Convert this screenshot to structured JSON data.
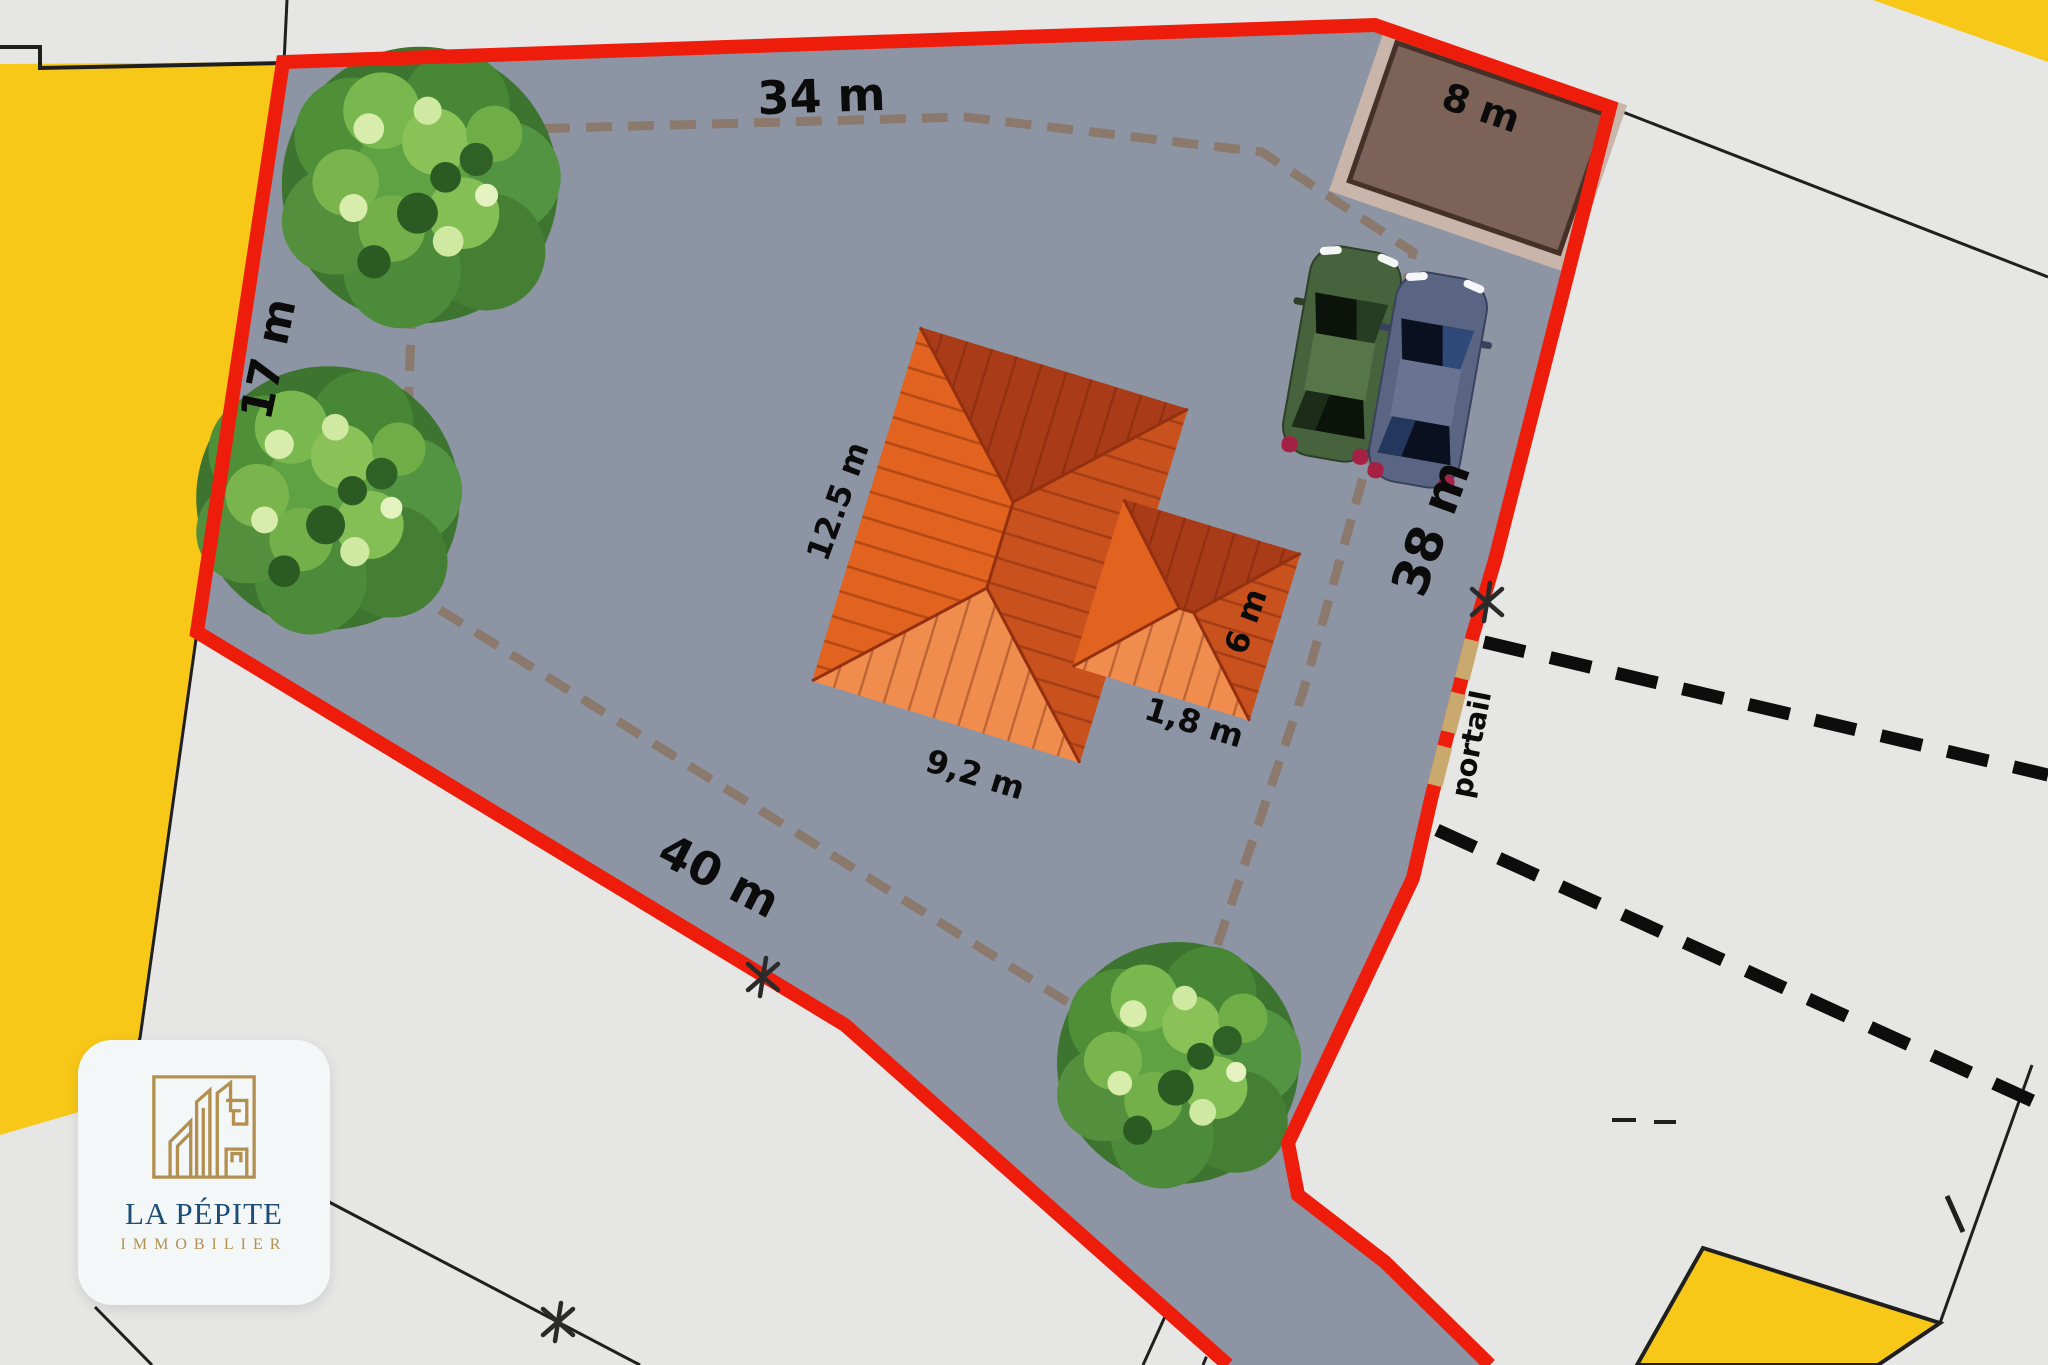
{
  "site_plan": {
    "colors": {
      "background": "#e6e6e5",
      "plot_fill": "#8d95a4",
      "boundary_red": "#ee1d0b",
      "parcel_yellow": "#f8c818",
      "inner_dash": "#8a796c",
      "road_dash": "#0d0d0d",
      "gate_tan": "#c9a96e",
      "roof_light": "#f08d4e",
      "roof_mid": "#e2631f",
      "roof_side": "#c8511e",
      "roof_dark": "#a93b18",
      "garage_fill": "#7c6257",
      "garage_frame": "#c9b5a9",
      "tree_green": "#4f8f38",
      "car_green": "#46633d",
      "car_blue": "#5a6483"
    },
    "boundary": {
      "top_label": "34 m",
      "left_label": "17 m",
      "bottom_label": "40 m",
      "right_label": "38 m"
    },
    "garage": {
      "label": "8 m"
    },
    "house": {
      "length_label": "12.5 m",
      "width_label": "9,2 m",
      "wing_side_label": "6 m",
      "wing_offset_label": "1,8 m"
    },
    "gate": {
      "label": "portail"
    }
  },
  "logo": {
    "brand": "LA PÉPITE",
    "subtitle": "IMMOBILIER"
  }
}
